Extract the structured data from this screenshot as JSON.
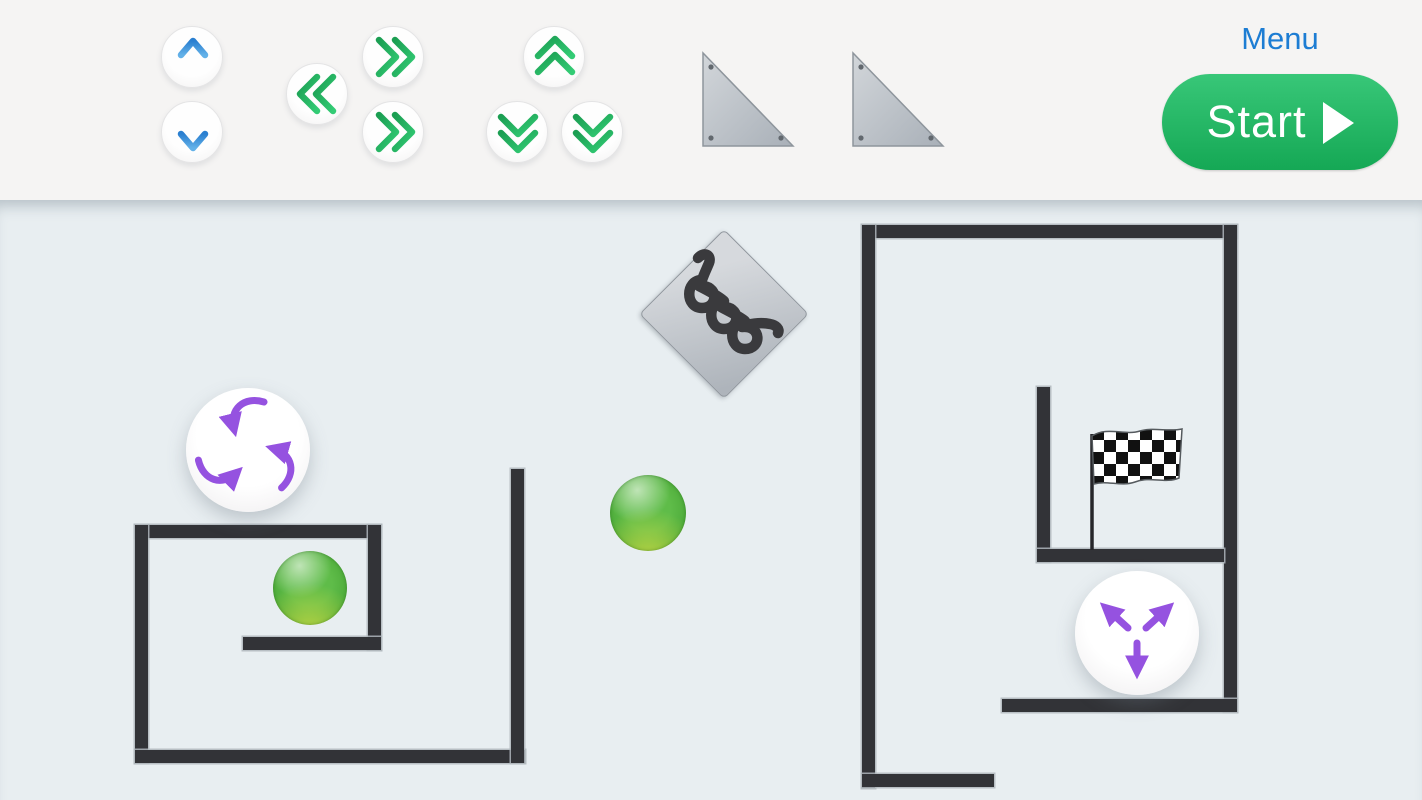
{
  "window": {
    "width": 1422,
    "height": 800,
    "app_type": "physics-puzzle-builder"
  },
  "toolbar": {
    "menu_label": "Menu",
    "start_button": {
      "label": "Start",
      "icon": "play-icon"
    },
    "palette_buttons": [
      {
        "icon": "arrow-up-icon",
        "color": "blue"
      },
      {
        "icon": "arrow-down-icon",
        "color": "blue"
      },
      {
        "icon": "double-chevron-left-icon",
        "color": "green"
      },
      {
        "icon": "double-chevron-right-icon",
        "color": "green"
      },
      {
        "icon": "double-chevron-right-icon",
        "color": "green"
      },
      {
        "icon": "double-chevron-up-icon",
        "color": "green"
      },
      {
        "icon": "double-chevron-down-icon",
        "color": "green"
      },
      {
        "icon": "double-chevron-down-icon",
        "color": "green"
      },
      {
        "icon": "ramp-triangle-icon",
        "color": "gray"
      },
      {
        "icon": "ramp-triangle-icon",
        "color": "gray"
      }
    ],
    "colors": {
      "toolbar_background": "#f5f4f3",
      "menu_link": "#1d7dd3",
      "start_gradient_top": "#38c778",
      "start_gradient_bottom": "#15a855",
      "blue_arrow_dark": "#2a7fd0",
      "blue_arrow_light": "#63b1e8",
      "green_arrow_dark": "#1b9e52",
      "green_arrow_light": "#33cc75",
      "triangle_fill": "#bcc2c9"
    }
  },
  "playfield": {
    "background": "#e8eef1",
    "wall_color": "#323337",
    "ball_color": "#4fae37",
    "portal_arrow_color": "#9552e0",
    "elements": [
      {
        "name": "spring-bumper-diamond",
        "count": 1
      },
      {
        "name": "attractor-portal-converging-arrows",
        "count": 1
      },
      {
        "name": "repulsor-portal-diverging-arrows",
        "count": 1
      },
      {
        "name": "green-ball",
        "count": 2
      },
      {
        "name": "checkered-flag-goal",
        "count": 1
      },
      {
        "name": "maze-wall-segment",
        "count": 13
      }
    ]
  }
}
